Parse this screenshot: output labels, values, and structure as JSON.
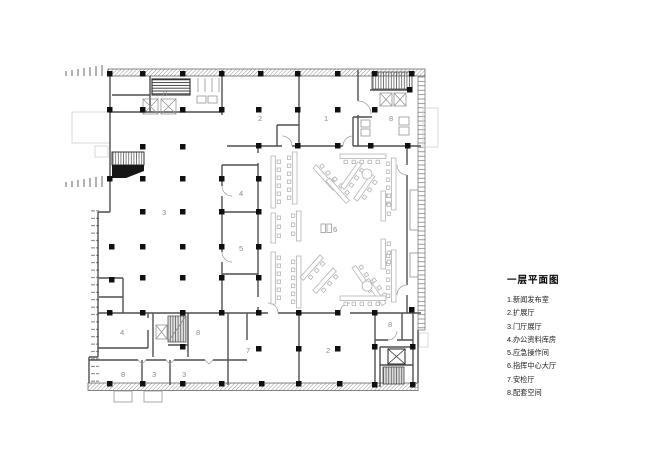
{
  "legend": {
    "title": "一层平面图",
    "items": [
      "1.新闻发布室",
      "2.扩展厅",
      "3.门厅展厅",
      "4.办公资料库房",
      "5.应急操作间",
      "6.指挥中心大厅",
      "7.安检厅",
      "8.配套空间"
    ]
  },
  "plan": {
    "room_labels": {
      "core_top_left": "8",
      "room_2_top": "2",
      "room_1": "1",
      "core_top_right": "8",
      "room_3": "3",
      "room_4_mid": "4",
      "room_5": "5",
      "room_6": "6",
      "room_4_bottom": "4",
      "room_8_mid": "8",
      "room_7": "7",
      "room_2_bottom": "2",
      "room_8_bottom_right": "8",
      "room_8_strip": "8",
      "room_3_strip_a": "3",
      "room_3_strip_b": "3"
    }
  }
}
